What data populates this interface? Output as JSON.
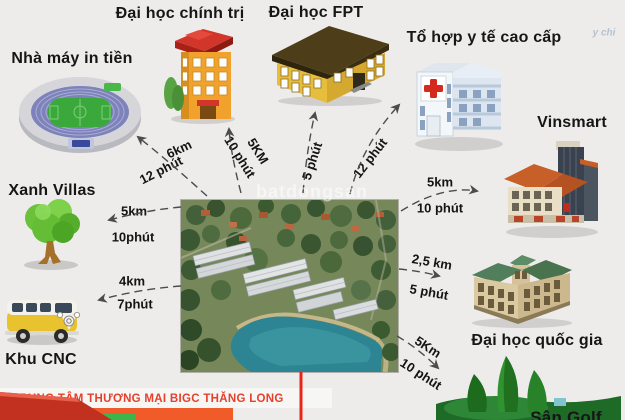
{
  "title": "Vi tri du an - location distance infographic",
  "watermark": {
    "center": "batdongsan",
    "top_right": "y chi"
  },
  "colors": {
    "background": "#edecea",
    "arrow": "#4c4c4c",
    "accent_red_line": "#e8251b",
    "bigc_text_red": "#e5402b",
    "bigc_banner_orange": "#f15a29",
    "bigc_green": "#3cb54a",
    "label_text": "#161616"
  },
  "center_project": {
    "description": "aerial render of townhouse project with lake"
  },
  "locations": [
    {
      "id": "nha-may-in-tien",
      "label": "Nhà máy in tiền",
      "icon": "stadium-icon",
      "distance_km": "6km",
      "travel_time": "12 phút"
    },
    {
      "id": "dai-hoc-chinh-tri",
      "label": "Đại học chính trị",
      "icon": "university-icon",
      "distance_km": "5KM",
      "travel_time": "10 phút"
    },
    {
      "id": "dai-hoc-fpt",
      "label": "Đại học FPT",
      "icon": "school-building-icon",
      "travel_time": "5 phút"
    },
    {
      "id": "to-hop-y-te-cao-cap",
      "label": "Tổ hợp y tế cao cấp",
      "icon": "hospital-icon",
      "travel_time": "12 phút"
    },
    {
      "id": "vinsmart",
      "label": "Vinsmart",
      "icon": "tower-building-icon",
      "distance_km": "5km",
      "travel_time": "10 phút"
    },
    {
      "id": "xanh-villas",
      "label": "Xanh Villas",
      "icon": "tree-icon",
      "distance_km": "5km",
      "travel_time": "10phút"
    },
    {
      "id": "khu-cnc",
      "label": "Khu CNC",
      "icon": "bus-icon",
      "distance_km": "4km",
      "travel_time": "7phút"
    },
    {
      "id": "dai-hoc-quoc-gia",
      "label": "Đại học quốc gia",
      "icon": "classic-building-icon",
      "distance_km": "2,5 km",
      "travel_time": "5 phút"
    },
    {
      "id": "san-golf",
      "label": "Sân Golf",
      "icon": "golf-course-icon",
      "distance_km": "5Km",
      "travel_time": "10 phút"
    },
    {
      "id": "bigc-thang-long",
      "label": "TRUNG TÂM THƯƠNG MẠI BIGC THĂNG LONG",
      "icon": "mall-icon"
    }
  ]
}
